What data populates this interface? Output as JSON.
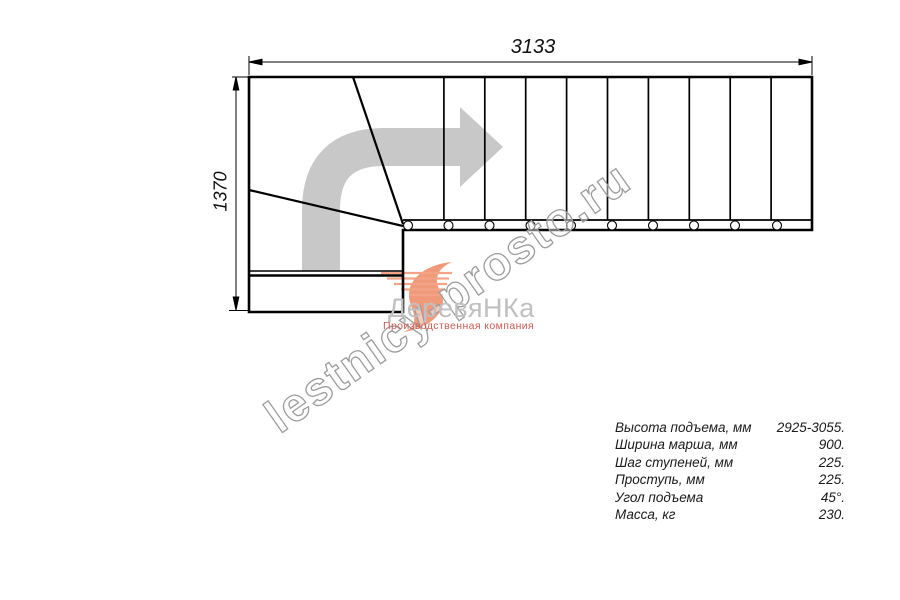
{
  "drawing": {
    "title": "staircase-plan-top-view",
    "dimensions": {
      "width_label": "3133",
      "height_label": "1370"
    },
    "direction_arrow_icon": "turn-right-arrow",
    "colors": {
      "line": "#000000",
      "arrow_gray": "#c8c8c8",
      "watermark_stroke": "#9c9c9c"
    }
  },
  "logo": {
    "name": "ДеревяНКа",
    "tagline": "Производственная компания",
    "swoosh_icon": "salmon-swoosh",
    "text_color": "#c1c0c0",
    "tagline_color": "#cb5a52",
    "accent_color": "#f09a7a"
  },
  "watermark": {
    "text": "lestnicy-prosto.ru"
  },
  "specs": {
    "rows": [
      {
        "label": "Высота подъема, мм",
        "value": "2925-3055."
      },
      {
        "label": "Ширина марша, мм",
        "value": "900."
      },
      {
        "label": "Шаг ступеней, мм",
        "value": "225."
      },
      {
        "label": "Проступь, мм",
        "value": "225."
      },
      {
        "label": "Угол подъема",
        "value": "45°."
      },
      {
        "label": "Масса, кг",
        "value": "230."
      }
    ]
  }
}
